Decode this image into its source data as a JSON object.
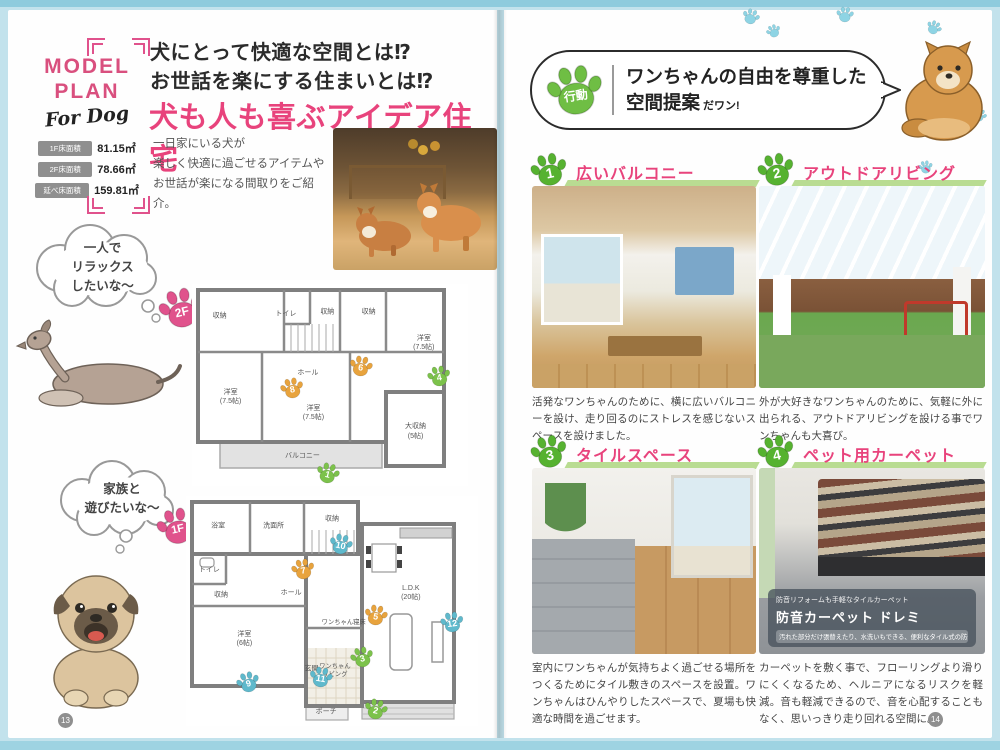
{
  "colors": {
    "background": "#c2e2ec",
    "pink": "#e8437c",
    "paw_green": "#6fbe44",
    "paw_orange": "#e8a33d",
    "paw_blue": "#5fb9cc",
    "paw_pink": "#e0528c",
    "deco_paw": "#8ed4e4"
  },
  "left": {
    "page_number": "13",
    "model_plan": {
      "title": "MODEL\nPLAN",
      "subtitle": "For Dog",
      "areas": [
        {
          "label": "1F床面積",
          "value": "81.15㎡"
        },
        {
          "label": "2F床面積",
          "value": "78.66㎡"
        },
        {
          "label": "延べ床面積",
          "value": "159.81㎡"
        }
      ]
    },
    "headline": {
      "sub1": "犬にとって快適な空間とは⁉",
      "sub2": "お世話を楽にする住まいとは⁉",
      "main": "犬も人も喜ぶアイデア住宅"
    },
    "intro": "一日家にいる犬が\n楽しく快適に過ごせるアイテムや\nお世話が楽になる間取りをご紹介。",
    "bubble1": "一人で\nリラックス\nしたいな〜",
    "bubble2": "家族と\n遊びたいな〜",
    "plan2f": {
      "floor": "2F",
      "rooms": [
        {
          "label": "収納"
        },
        {
          "label": "トイレ"
        },
        {
          "label": "収納"
        },
        {
          "label": "収納"
        },
        {
          "label": "洋室\n(7.5帖)"
        },
        {
          "label": "ホール"
        },
        {
          "label": "洋室\n(7.5帖)"
        },
        {
          "label": "洋室\n(7.5帖)"
        },
        {
          "label": "大収納\n(5帖)"
        },
        {
          "label": "バルコニー"
        }
      ],
      "paws": [
        {
          "num": "8",
          "color": "orange"
        },
        {
          "num": "6",
          "color": "orange"
        },
        {
          "num": "4",
          "color": "green"
        },
        {
          "num": "1",
          "color": "green"
        }
      ]
    },
    "plan1f": {
      "floor": "1F",
      "rooms": [
        {
          "label": "浴室"
        },
        {
          "label": "洗面所"
        },
        {
          "label": "収納"
        },
        {
          "label": "トイレ"
        },
        {
          "label": "収納"
        },
        {
          "label": "洋室\n(6帖)"
        },
        {
          "label": "ホール"
        },
        {
          "label": "玄関"
        },
        {
          "label": "ポーチ"
        },
        {
          "label": "ワンちゃん寝床"
        },
        {
          "label": "ワンちゃん\nリビング"
        },
        {
          "label": "L.D.K\n(20帖)"
        }
      ],
      "paws": [
        {
          "num": "10",
          "color": "blue"
        },
        {
          "num": "7",
          "color": "orange"
        },
        {
          "num": "5",
          "color": "orange"
        },
        {
          "num": "3",
          "color": "green"
        },
        {
          "num": "11",
          "color": "blue"
        },
        {
          "num": "9",
          "color": "blue"
        },
        {
          "num": "2",
          "color": "green"
        },
        {
          "num": "12",
          "color": "blue"
        }
      ]
    }
  },
  "right": {
    "page_number": "14",
    "badge": "行動",
    "bubble": {
      "title": "ワンちゃんの自由を尊重した\n空間提案",
      "suffix": "だワン!"
    },
    "sections": [
      {
        "num": "1",
        "title": "広いバルコニー",
        "desc": "活発なワンちゃんのために、横に広いバルコニーを設け、走り回るのにストレスを感じないスペースを設けました。"
      },
      {
        "num": "2",
        "title": "アウトドアリビング",
        "desc": "外が大好きなワンちゃんのために、気軽に外に出られる、アウトドアリビングを設ける事でワンちゃんも大喜び。"
      },
      {
        "num": "3",
        "title": "タイルスペース",
        "desc": "室内にワンちゃんが気持ちよく過ごせる場所をつくるためにタイル敷きのスペースを設置。ワンちゃんはひんやりしたスペースで、夏場も快適な時間を過ごせます。"
      },
      {
        "num": "4",
        "title": "ペット用カーペット",
        "desc": "カーペットを敷く事で、フローリングより滑りにくくなるため、ヘルニアになるリスクを軽減。音も軽減できるので、音を心配することもなく、思いっきり走り回れる空間に。",
        "overlay_small": "防音リフォームも手軽なタイルカーペット",
        "overlay_product": "防音カーペット ドレミ",
        "overlay_caption": "汚れた部分だけ張替えたり、水洗いもできる、便利なタイル式の防音カーペット。"
      }
    ]
  }
}
